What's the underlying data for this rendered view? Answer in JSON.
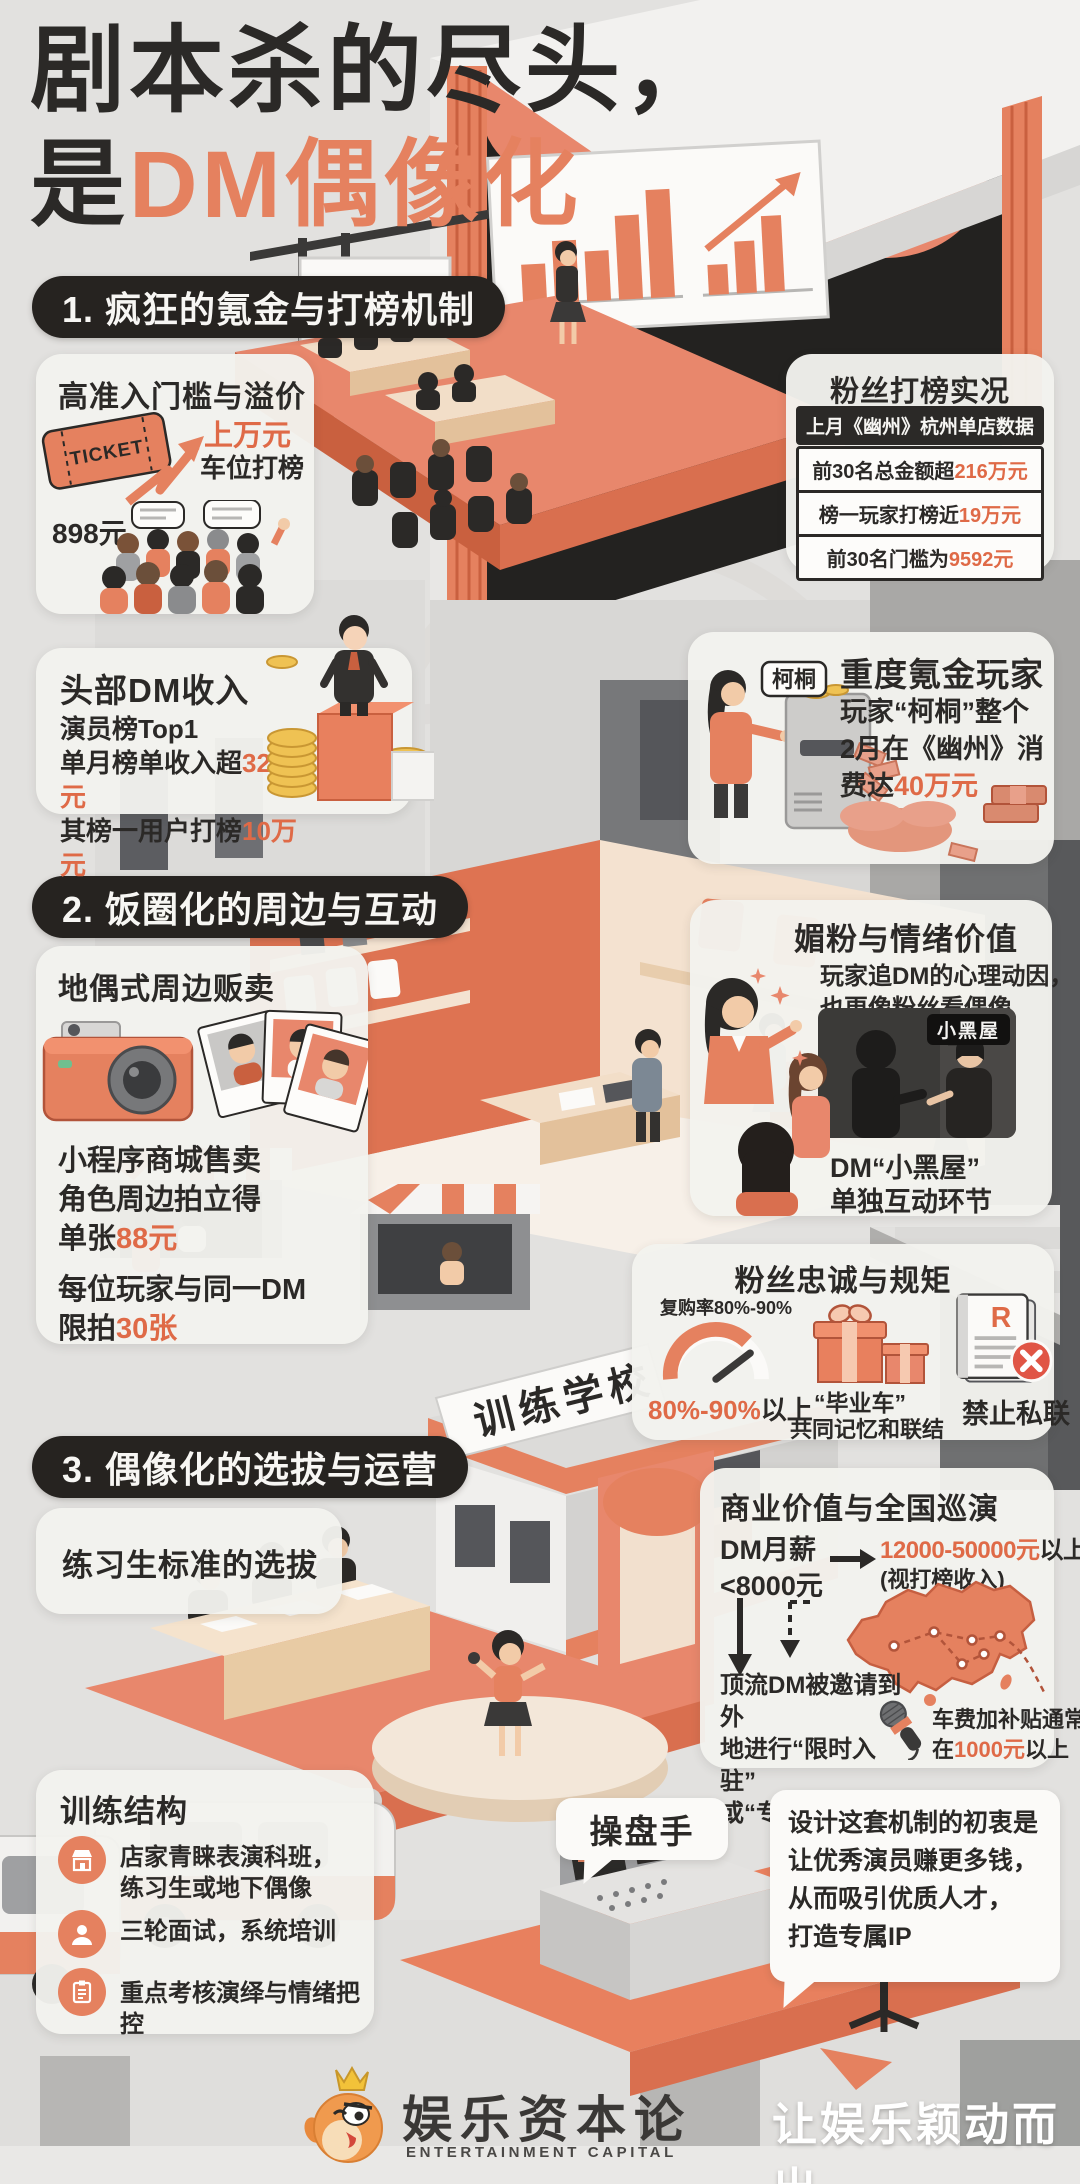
{
  "colors": {
    "accent": "#E5815F",
    "accent_deep": "#D96F4F",
    "number": "#DF6A47",
    "ink": "#2B2927",
    "pill_bg": "#262320",
    "card_bg": "#F3F2EE",
    "page_bg": "#E2E1DF"
  },
  "title": {
    "line1": "剧本杀的尽头，",
    "line2_black": "是",
    "line2_accent": "DM偶像化"
  },
  "sections": [
    {
      "label": "1. 疯狂的氪金与打榜机制"
    },
    {
      "label": "2. 饭圈化的周边与互动"
    },
    {
      "label": "3. 偶像化的选拔与运营"
    }
  ],
  "cards": {
    "entry": {
      "title": "高准入门槛与溢价",
      "ticket": "TICKET",
      "price": "898元",
      "peak": "上万元",
      "peak_sub": "车位打榜"
    },
    "fan_ranking": {
      "title": "粉丝打榜实况",
      "header": "上月《幽州》杭州单店数据",
      "rows": [
        {
          "pre": "前30名总金额超",
          "num": "216万元"
        },
        {
          "pre": "榜一玩家打榜近",
          "num": "19万元"
        },
        {
          "pre": "前30名门槛为",
          "num": "9592元"
        }
      ]
    },
    "dm_income": {
      "title": "头部DM收入",
      "line1": "演员榜Top1",
      "line2_pre": "单月榜单收入超",
      "line2_num": "32万元",
      "line3_pre": "其榜一用户打榜",
      "line3_num": "10万元"
    },
    "whale": {
      "title": "重度氪金玩家",
      "name_tag": "柯桐",
      "line1": "玩家“柯桐”整个",
      "line2": "2月在《幽州》消",
      "line3_pre": "费达",
      "line3_num": "40万元"
    },
    "merch": {
      "title": "地偶式周边贩卖",
      "line1": "小程序商城售卖",
      "line2": "角色周边拍立得",
      "line3_pre": "单张",
      "line3_num": "88元",
      "line4": "每位玩家与同一DM",
      "line5_pre": "限拍",
      "line5_num": "30张"
    },
    "emotion": {
      "title": "媚粉与情绪价值",
      "line1": "玩家追DM的心理动因，",
      "line2": "也更像粉丝看偶像",
      "badge": "小黑屋",
      "caption1": "DM“小黑屋”",
      "caption2": "单独互动环节"
    },
    "loyalty": {
      "title": "粉丝忠诚与规矩",
      "gauge_label": "复购率80%-90%",
      "gauge_num": "80%-90%",
      "gauge_suffix": "以上",
      "gift_line1": "“毕业车”",
      "gift_line2": "共同记忆和联结",
      "doc_letter": "R",
      "ban": "禁止私联"
    },
    "selection": {
      "title": "练习生标准的选拔"
    },
    "commercial": {
      "title": "商业价值与全国巡演",
      "salary1": "DM月薪",
      "salary2": "<8000元",
      "range_num": "12000-50000元",
      "range_suffix": "以上",
      "range_note": "(视打榜收入)",
      "invite1": "顶流DM被邀请到外",
      "invite2": "地进行“限时入驻”",
      "invite3": "或“专场”",
      "fee1": "车费加补贴通常",
      "fee2_pre": "在",
      "fee2_num": "1000元",
      "fee2_suffix": "以上"
    },
    "training": {
      "title": "训练结构",
      "items": [
        {
          "icon": "storefront-icon",
          "text1": "店家青睐表演科班，",
          "text2": "练习生或地下偶像"
        },
        {
          "icon": "person-icon",
          "text1": "三轮面试，系统培训",
          "text2": ""
        },
        {
          "icon": "clipboard-icon",
          "text1": "重点考核演绎与情绪把控",
          "text2": ""
        }
      ]
    },
    "operator": {
      "bubble": "操盘手",
      "quote1": "设计这套机制的初衷是",
      "quote2": "让优秀演员赚更多钱，",
      "quote3": "从而吸引优质人才，",
      "quote4": "打造专属IP"
    }
  },
  "scene": {
    "school_sign": "训练学校"
  },
  "footer": {
    "logo_cn": "娱乐资本论",
    "logo_en": "ENTERTAINMENT CAPITAL",
    "watermark": "让娱乐颖动而出"
  }
}
